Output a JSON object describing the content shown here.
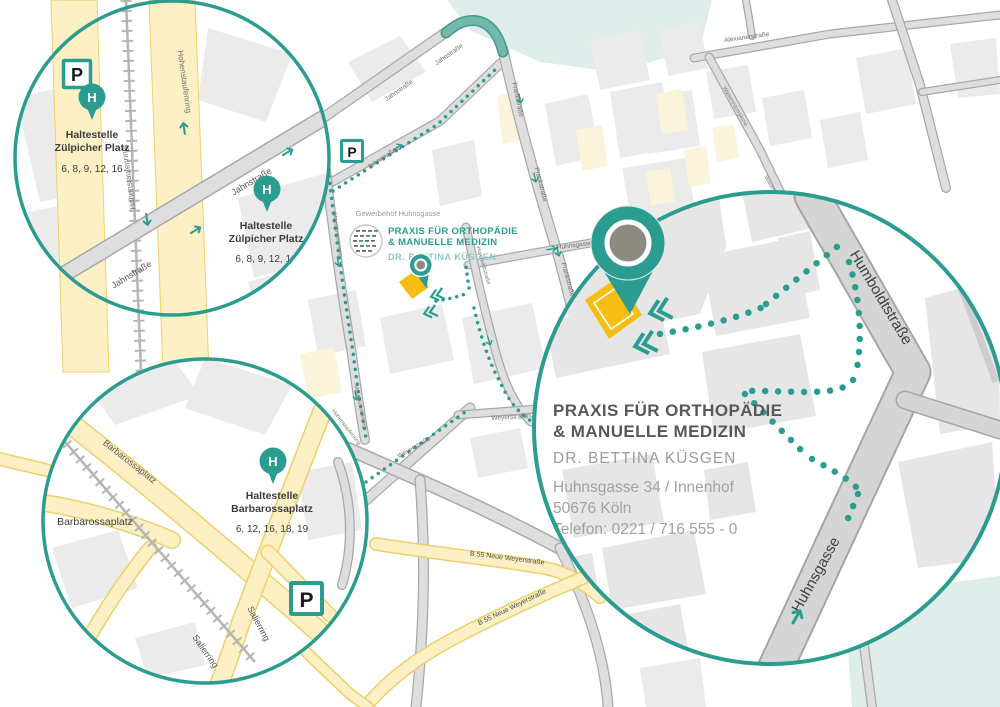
{
  "markers": {
    "parking_label": "P",
    "stop_letter": "H"
  },
  "stops": {
    "zuelpicher": {
      "title_line1": "Haltestelle",
      "title_line2": "Zülpicher Platz",
      "lines": "6, 8, 9, 12, 16"
    },
    "barbarossa": {
      "title_line1": "Haltestelle",
      "title_line2": "Barbarossaplatz",
      "lines": "6, 12, 16, 18, 19"
    }
  },
  "streets": {
    "jahnstrasse": "Jahnstraße",
    "hohenstaufenring": "Hohenstaufenring",
    "frankstrasse": "Frankstraße",
    "huhnsgasse": "Huhnsgasse",
    "humboldtstrasse": "Humboldtstraße",
    "mauritiussteinweg": "Mauritiussteinweg",
    "weyerstrasse": "Weyerstraße",
    "alexianerstrasse": "Alexianerstraße",
    "waisenhausgasse": "Waisenhausgasse",
    "b55_neue_weyerstrasse": "B 55 Neue Weyerstraße",
    "barbarossaplatz": "Barbarossaplatz",
    "salierring": "Salierring"
  },
  "places": {
    "barbarossaplatz": "Barbarossaplatz",
    "gewerbehof": "Gewerbehof Huhnsgasse"
  },
  "practice": {
    "name_line1": "PRAXIS FÜR ORTHOPÄDIE",
    "name_line2": "& MANUELLE MEDIZIN",
    "doctor": "DR. BETTINA KÜSGEN",
    "address_street": "Huhnsgasse 34 / Innenhof",
    "address_city": "50676 Köln",
    "phone": "Telefon: 0221 / 716 555 - 0"
  },
  "colors": {
    "teal": "#2B9C90",
    "teal_light": "#8FC8C0",
    "road_yellow": "#FCF0C4",
    "road_yellow_border": "#ECD06B",
    "building_highlight_yellow": "#F5BE10",
    "mint": "#DEEDE9"
  }
}
